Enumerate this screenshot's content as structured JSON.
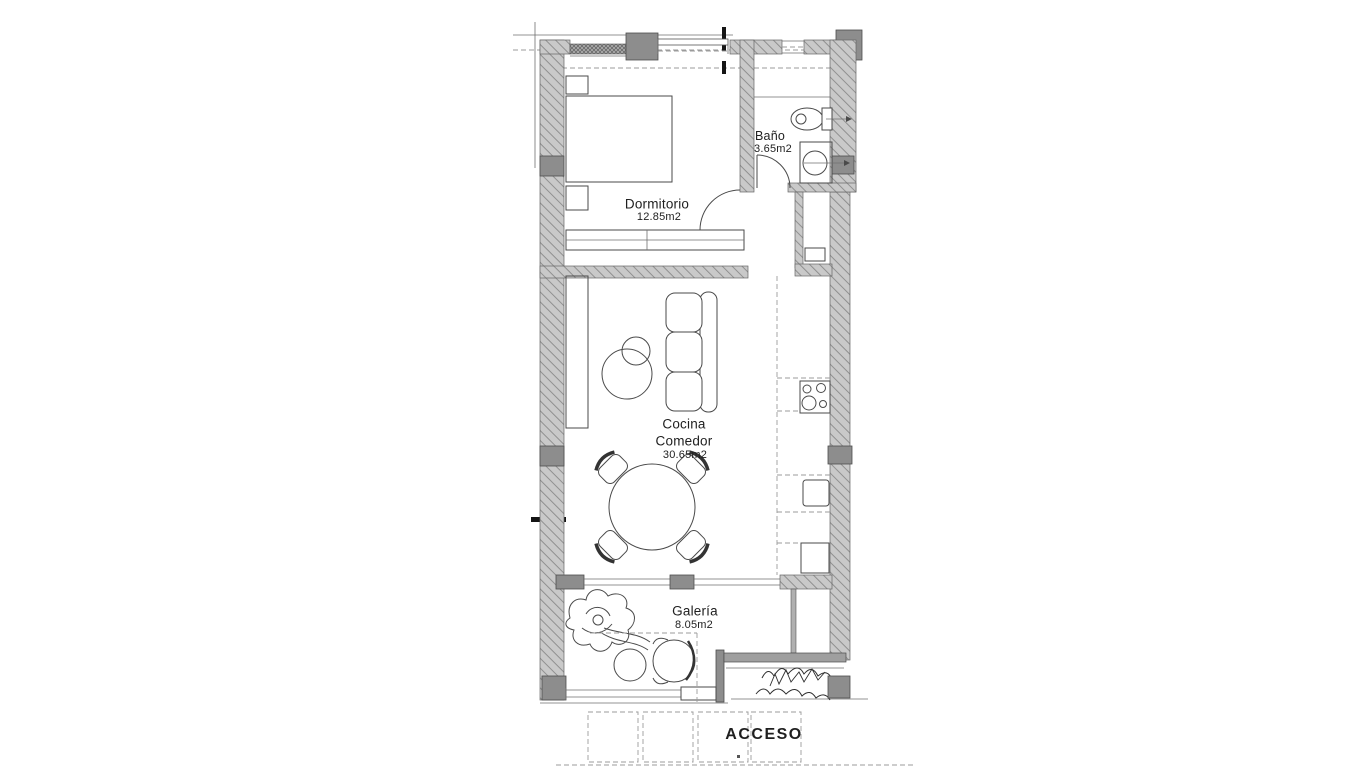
{
  "floorplan": {
    "rooms": {
      "bano": {
        "name": "Baño",
        "area": "3.65m2"
      },
      "dormitorio": {
        "name": "Dormitorio",
        "area": "12.85m2"
      },
      "cocina": {
        "line1": "Cocina",
        "line2": "Comedor",
        "area": "30.65m2"
      },
      "galeria": {
        "name": "Galería",
        "area": "8.05m2"
      }
    },
    "entrance": {
      "label": "ACCESO"
    },
    "colors": {
      "background": "#ffffff",
      "wall_fill": "#c9c9c9",
      "wall_hatch": "#8f8f8f",
      "column": "#8d8d8d",
      "line": "#4a4a4a",
      "dashed": "#9b9b9b",
      "text": "#1f1f1f"
    }
  }
}
